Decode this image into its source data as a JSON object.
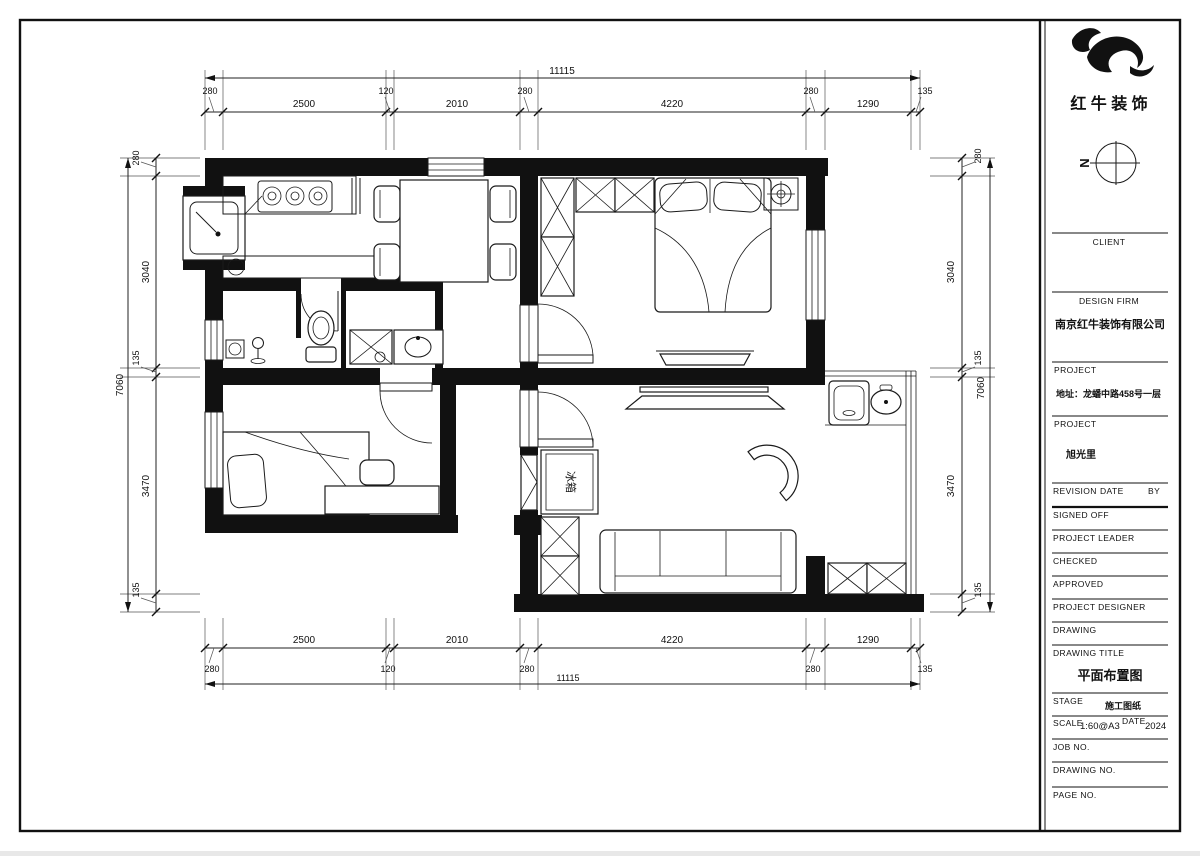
{
  "sheet": {
    "company_logo_text": "红 牛 装 饰",
    "north_indicator": "N"
  },
  "title_block": {
    "client_label": "CLIENT",
    "design_firm_label": "DESIGN FIRM",
    "design_firm_value": "南京红牛装饰有限公司",
    "project_label_1": "PROJECT",
    "project_address": "地址：龙蟠中路458号一层",
    "project_label_2": "PROJECT",
    "project_name": "旭光里",
    "revision_label": "REVISION",
    "date_label": "DATE",
    "by_label": "BY",
    "signed_off_label": "SIGNED OFF",
    "project_leader_label": "PROJECT LEADER",
    "checked_label": "CHECKED",
    "approved_label": "APPROVED",
    "project_designer_label": "PROJECT DESIGNER",
    "drawing_label": "DRAWING",
    "drawing_title_label": "DRAWING TITLE",
    "drawing_title_value": "平面布置图",
    "stage_label": "STAGE",
    "stage_value": "施工图纸",
    "scale_label": "SCALE",
    "scale_value": "1:60@A3",
    "date_field_label": "DATE",
    "date_value": "2024",
    "job_no_label": "JOB NO.",
    "drawing_no_label": "DRAWING NO.",
    "page_no_label": "PAGE NO."
  },
  "dimensions": {
    "top": {
      "total": "11115",
      "segments": [
        "280",
        "2500",
        "120",
        "2010",
        "280",
        "4220",
        "280",
        "1290",
        "135"
      ]
    },
    "bottom": {
      "total": "11115",
      "segments": [
        "280",
        "2500",
        "120",
        "2010",
        "280",
        "4220",
        "280",
        "1290",
        "135"
      ]
    },
    "left": {
      "total": "7060",
      "segments": [
        "280",
        "3040",
        "135",
        "3470",
        "135"
      ]
    },
    "right": {
      "total": "7060",
      "segments": [
        "280",
        "3040",
        "135",
        "3470",
        "135"
      ]
    }
  },
  "plan": {
    "fridge_label": "冰箱"
  }
}
